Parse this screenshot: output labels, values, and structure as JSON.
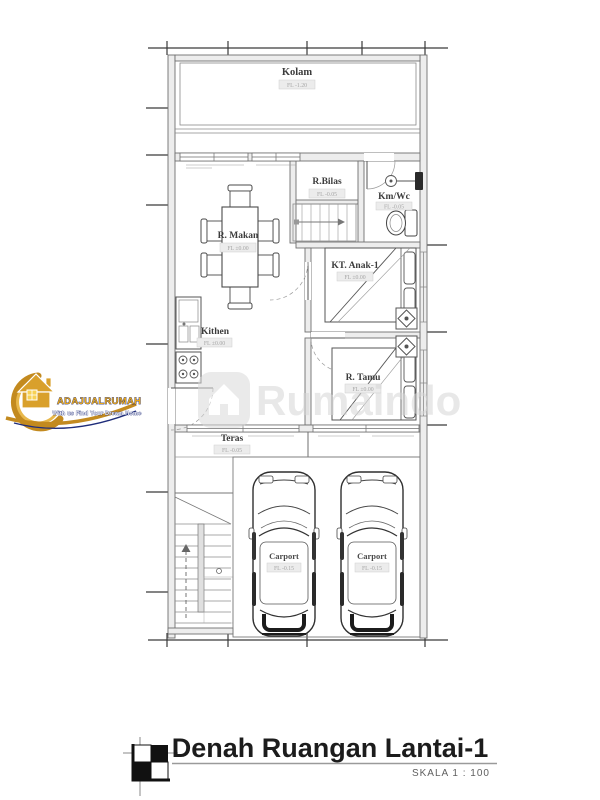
{
  "plan": {
    "rooms": {
      "kolam": {
        "label": "Kolam",
        "elev": "FL -1.20"
      },
      "r_makan": {
        "label": "R. Makan",
        "elev": "FL ±0.00"
      },
      "r_bilas": {
        "label": "R.Bilas",
        "elev": "FL -0.05"
      },
      "km_wc": {
        "label": "Km/Wc",
        "elev": "FL -0.05"
      },
      "kt_anak_1": {
        "label": "KT. Anak-1",
        "elev": "FL ±0.00"
      },
      "kithen": {
        "label": "Kithen",
        "elev": "FL ±0.00"
      },
      "r_tamu": {
        "label": "R. Tamu",
        "elev": "FL ±0.00"
      },
      "teras": {
        "label": "Teras",
        "elev": "FL -0.05"
      },
      "carport": {
        "label": "Carport",
        "elev": "FL -0.15"
      }
    }
  },
  "title_block": {
    "title": "Denah Ruangan Lantai-1",
    "scale": "SKALA 1 : 100"
  },
  "logo": {
    "brand": "ADAJUALRUMAH",
    "tagline": "With us Find Your Dream Home"
  },
  "watermark": {
    "text": "Rumaindo"
  },
  "colors": {
    "linework": "#6f6f6f",
    "wall_fill": "#ededed",
    "label_text": "#3c3c3c",
    "tag_text": "#a6a6a6",
    "logo_gold": "#d49a2a",
    "logo_navy": "#1f2d7a",
    "watermark_gray": "#d6d6d6",
    "title_text": "#1c1c1c"
  }
}
